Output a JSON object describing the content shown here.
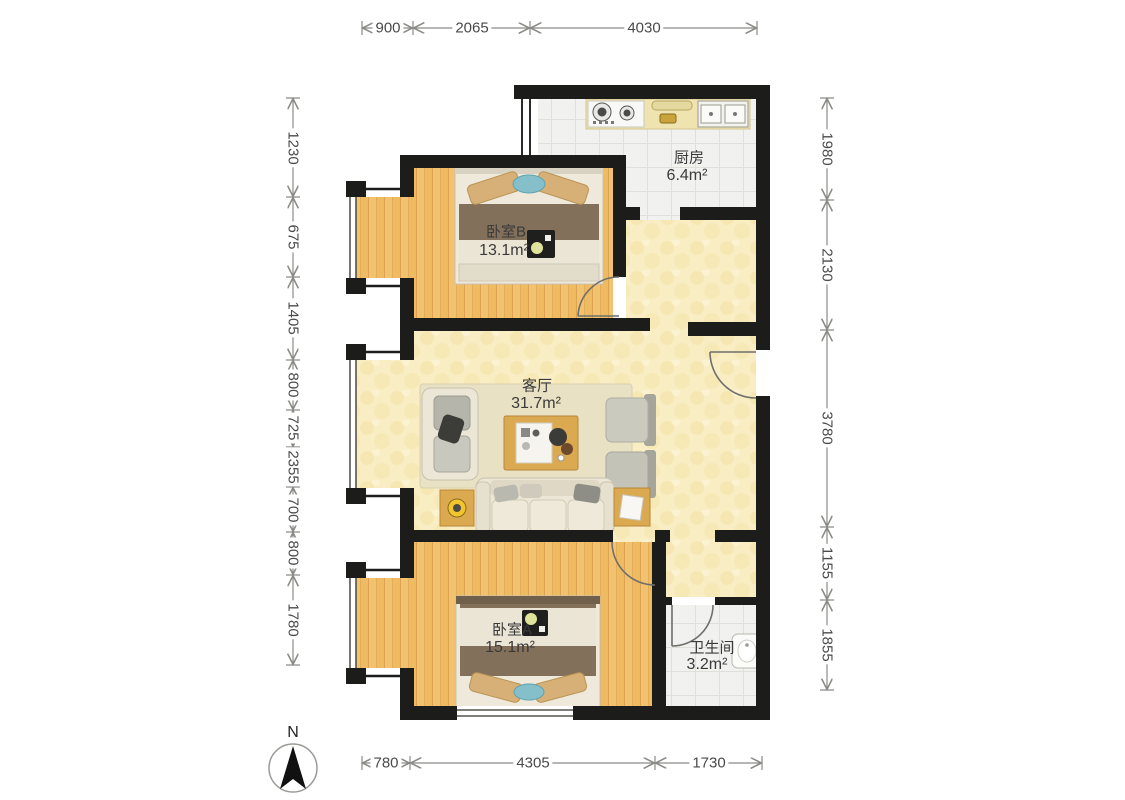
{
  "plan": {
    "compass_label": "N",
    "rooms": [
      {
        "id": "kitchen",
        "name": "厨房",
        "area": "6.4m²"
      },
      {
        "id": "bedroom-b",
        "name": "卧室B",
        "area": "13.1m²"
      },
      {
        "id": "living",
        "name": "客厅",
        "area": "31.7m²"
      },
      {
        "id": "bedroom-a",
        "name": "卧室A",
        "area": "15.1m²"
      },
      {
        "id": "bathroom",
        "name": "卫生间",
        "area": "3.2m²"
      }
    ],
    "dimensions": {
      "top": [
        "900",
        "2065",
        "4030"
      ],
      "left": [
        "1230",
        "675",
        "1405",
        "800",
        "725",
        "2355",
        "700",
        "800",
        "1780"
      ],
      "right": [
        "1980",
        "2130",
        "3780",
        "1155",
        "1855"
      ],
      "bottom": [
        "780",
        "4305",
        "1730"
      ]
    },
    "colors": {
      "wall": "#1c1c1a",
      "wood_floor": "#f1c26f",
      "tile_floor": "#f1f1ef",
      "hall_floor": "#f9edc4",
      "dimension_text": "#4a4a4a"
    }
  }
}
